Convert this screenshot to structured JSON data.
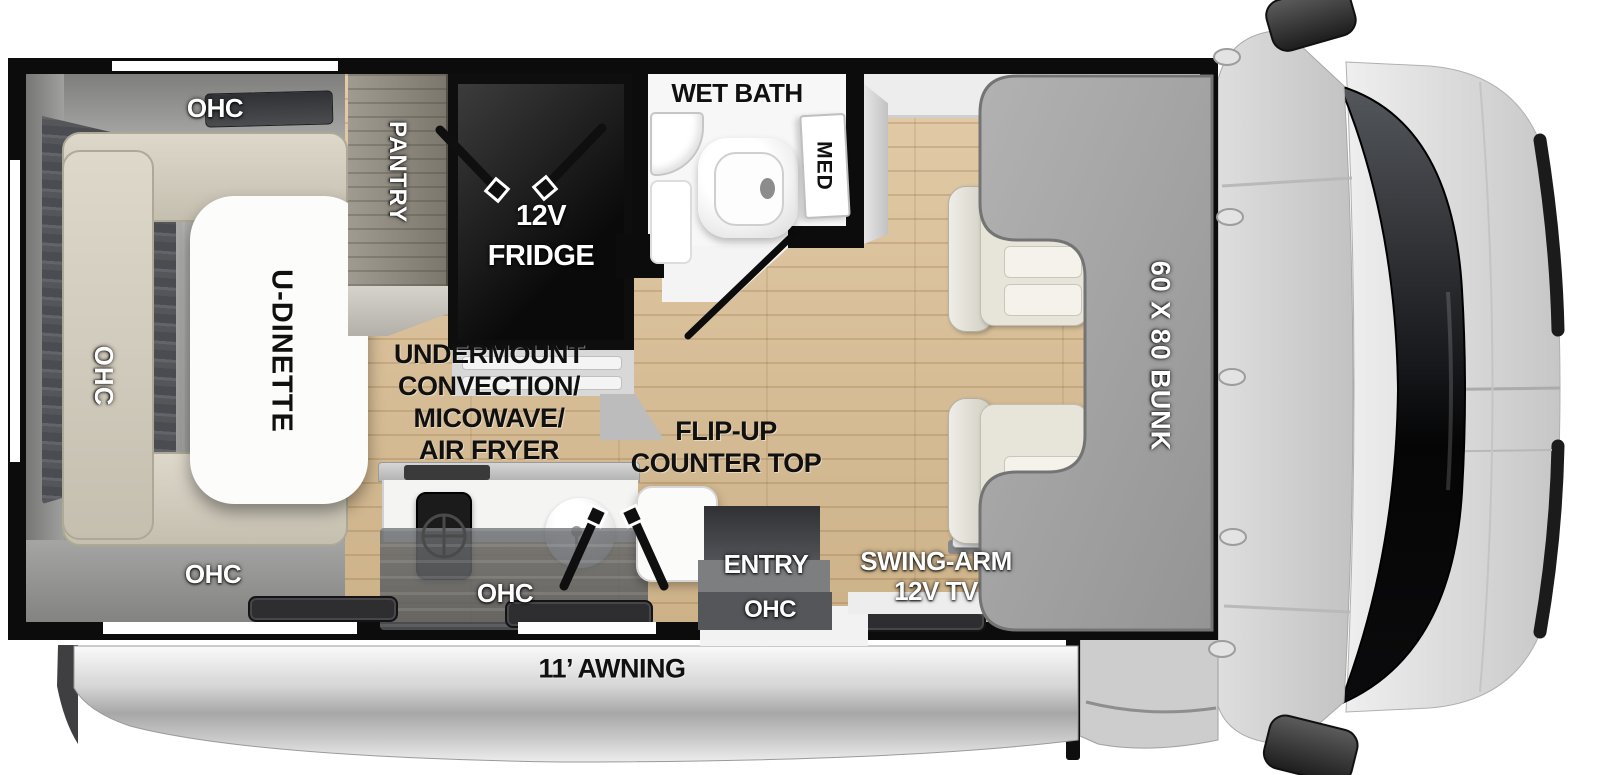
{
  "labels": {
    "ohc_dinette_top": "OHC",
    "ohc_dinette_left": "OHC",
    "ohc_dinette_bottom": "OHC",
    "dinette_table": "U-DINETTE",
    "pantry": "PANTRY",
    "fridge_line1": "12V",
    "fridge_line2": "FRIDGE",
    "wet_bath": "WET BATH",
    "med": "MED",
    "appliance_lines": [
      "UNDERMOUNT",
      "CONVECTION/",
      "MICOWAVE/",
      "AIR FRYER"
    ],
    "counter_lines": [
      "FLIP-UP",
      "COUNTER TOP"
    ],
    "ohc_kitchen": "OHC",
    "entry": "ENTRY",
    "ohc_entry": "OHC",
    "tv_lines": [
      "SWING-ARM",
      "12V TV"
    ],
    "bunk": "60 X 80 BUNK",
    "awning": "11’ AWNING"
  },
  "colors": {
    "wall": "#0c0c0c",
    "wood_floor": "#d9c29c",
    "bunk_gray": "#a2a2a2",
    "label_light": "#ffffff",
    "label_dark": "#101010",
    "awning_silver": "#c9c9c9"
  }
}
